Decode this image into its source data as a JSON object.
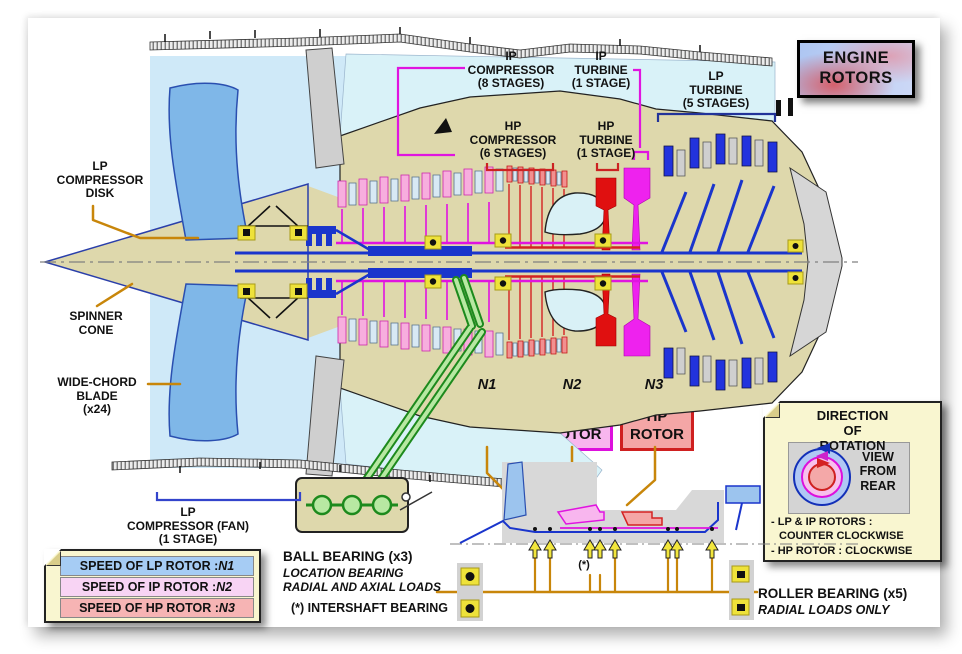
{
  "colors": {
    "lp_rotor_blue": "#1a35cc",
    "ip_rotor_magenta": "#e014e0",
    "hp_rotor_red": "#d42222",
    "casing_tan": "#ded8ac",
    "bypass_cyan": "#d9f2f8",
    "fan_blade_blue": "#7fb7e8",
    "bearing_yellow": "#eee23a",
    "leader_gold": "#c8860a",
    "gearbox_green": "#1d8a1d",
    "legend_cream": "#f9f6d0"
  },
  "title_box": {
    "text": "ENGINE\nROTORS"
  },
  "engine_labels": {
    "lp_compressor_disk": "LP\nCOMPRESSOR\nDISK",
    "spinner_cone": "SPINNER\nCONE",
    "wide_chord_blade": "WIDE-CHORD\nBLADE\n(x24)",
    "lp_compressor_fan": "LP\nCOMPRESSOR (FAN)\n(1 STAGE)",
    "ip_compressor": "IP\nCOMPRESSOR\n(8 STAGES)",
    "hp_compressor": "HP\nCOMPRESSOR\n(6 STAGES)",
    "ip_turbine": "IP\nTURBINE\n(1 STAGE)",
    "hp_turbine": "HP\nTURBINE\n(1 STAGE)",
    "lp_turbine": "LP\nTURBINE\n(5 STAGES)"
  },
  "rotor_boxes": [
    {
      "tag": "N1",
      "label": "LP\nROTOR"
    },
    {
      "tag": "N2",
      "label": "IP\nROTOR"
    },
    {
      "tag": "N3",
      "label": "HP\nROTOR"
    }
  ],
  "speed_legend": {
    "rows": [
      {
        "text": "SPEED OF LP ROTOR : ",
        "n": "N1"
      },
      {
        "text": "SPEED OF IP ROTOR : ",
        "n": "N2"
      },
      {
        "text": "SPEED OF HP ROTOR : ",
        "n": "N3"
      }
    ]
  },
  "bearing_notes": {
    "ball_title": "BALL BEARING (x3)",
    "ball_sub": "LOCATION BEARING\nRADIAL AND AXIAL LOADS",
    "intershaft": "(*) INTERSHAFT BEARING",
    "intershaft_mark": "(*)",
    "roller_title": "ROLLER BEARING (x5)",
    "roller_sub": "RADIAL LOADS ONLY"
  },
  "rotation_box": {
    "title": "DIRECTION\nOF ROTATION",
    "view": "VIEW\nFROM\nREAR",
    "note1_line1": "- LP & IP ROTORS :",
    "note1_line2": "COUNTER CLOCKWISE",
    "note2": "- HP ROTOR : CLOCKWISE"
  }
}
